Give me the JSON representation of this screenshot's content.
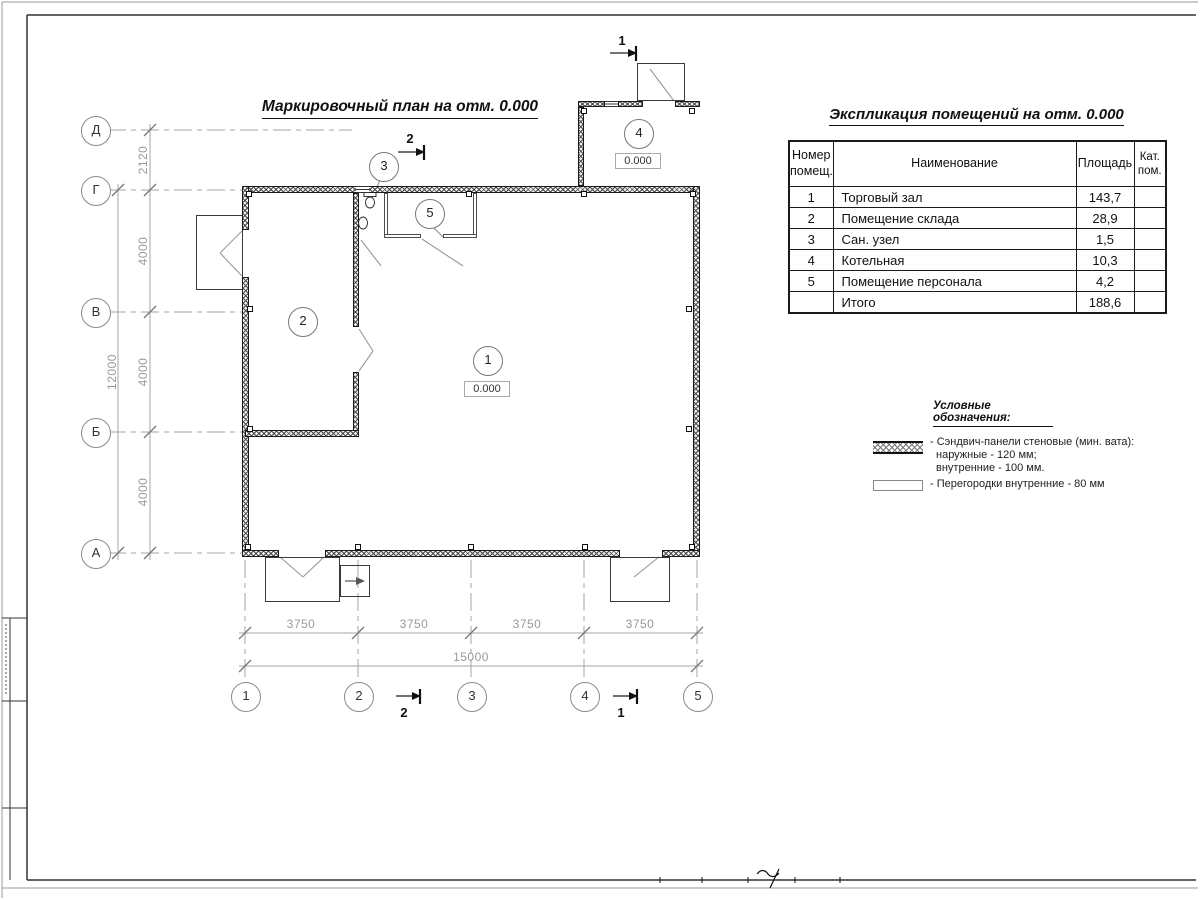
{
  "titles": {
    "plan": "Маркировочный план на отм. 0.000",
    "table": "Экспликация помещений на отм. 0.000",
    "legend": "Условные обозначения:"
  },
  "table": {
    "col_num": "Номер\nпомещ.",
    "col_name": "Наименование",
    "col_area": "Площадь",
    "col_cat": "Кат.\nпом.",
    "rows": [
      {
        "num": "1",
        "name": "Торговый зал",
        "area": "143,7",
        "cat": ""
      },
      {
        "num": "2",
        "name": "Помещение склада",
        "area": "28,9",
        "cat": ""
      },
      {
        "num": "3",
        "name": "Сан. узел",
        "area": "1,5",
        "cat": ""
      },
      {
        "num": "4",
        "name": "Котельная",
        "area": "10,3",
        "cat": ""
      },
      {
        "num": "5",
        "name": "Помещение персонала",
        "area": "4,2",
        "cat": ""
      }
    ],
    "total": {
      "label": "Итого",
      "area": "188,6"
    }
  },
  "legend": {
    "item1": {
      "line1": "- Сэндвич-панели стеновые (мин. вата):",
      "line2": "наружные - 120 мм;",
      "line3": "внутренние - 100 мм."
    },
    "item2": {
      "line1": "- Перегородки внутренние - 80 мм"
    }
  },
  "axes": {
    "rows": [
      "Д",
      "Г",
      "В",
      "Б",
      "А"
    ],
    "cols": [
      "1",
      "2",
      "3",
      "4",
      "5"
    ],
    "row_dims": [
      "2120",
      "4000",
      "4000",
      "4000"
    ],
    "row_total": "12000",
    "col_dims": [
      "3750",
      "3750",
      "3750",
      "3750"
    ],
    "col_total": "15000"
  },
  "rooms": {
    "r1": {
      "num": "1",
      "elev": "0.000"
    },
    "r2": {
      "num": "2"
    },
    "r3": {
      "num": "3"
    },
    "r4": {
      "num": "4",
      "elev": "0.000"
    },
    "r5": {
      "num": "5"
    }
  },
  "sections": {
    "s1": "1",
    "s2": "2"
  }
}
